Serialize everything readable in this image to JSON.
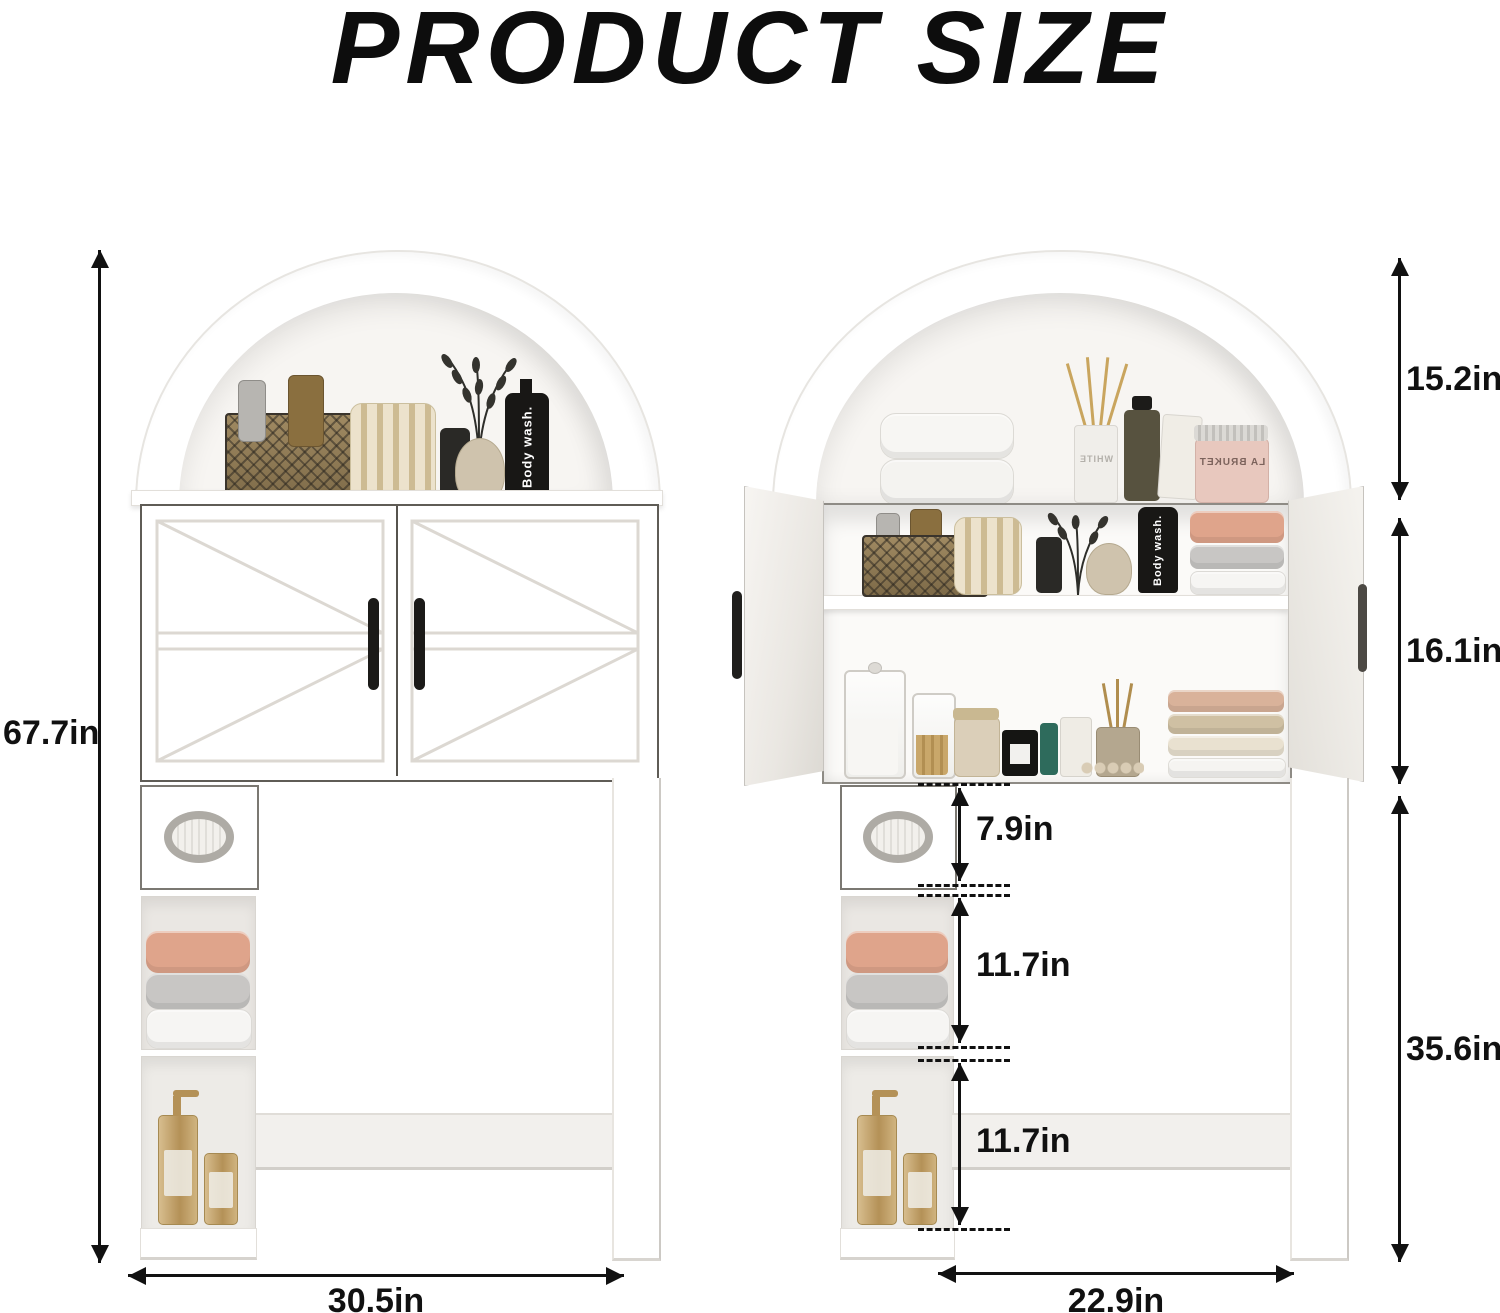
{
  "title": "PRODUCT SIZE",
  "colors": {
    "ink": "#111111",
    "cabinet_white": "#ffffff",
    "edge_gray": "#d8d5d0",
    "towel_peach": "#dfa48b",
    "towel_gray": "#c8c6c4",
    "towel_white": "#f6f5f3",
    "bottle_black": "#181715",
    "gold": "#c3a36d",
    "jar_pink": "#e8c8be"
  },
  "front_view": {
    "dims": {
      "overall_height": "67.7in",
      "overall_width": "30.5in"
    },
    "products": {
      "body_wash": "Body wash."
    }
  },
  "open_view": {
    "dims": {
      "arch_opening_height": "15.2in",
      "cabinet_height": "16.1in",
      "clearance_height": "35.6in",
      "tissue_door_height": "7.9in",
      "middle_cubby_height": "11.7in",
      "bottom_cubby_height": "11.7in",
      "inner_width": "22.9in"
    },
    "products": {
      "body_wash": "Body wash.",
      "jar_brand": "LA BRUKET",
      "diffuser_brand": "WHITE"
    }
  }
}
